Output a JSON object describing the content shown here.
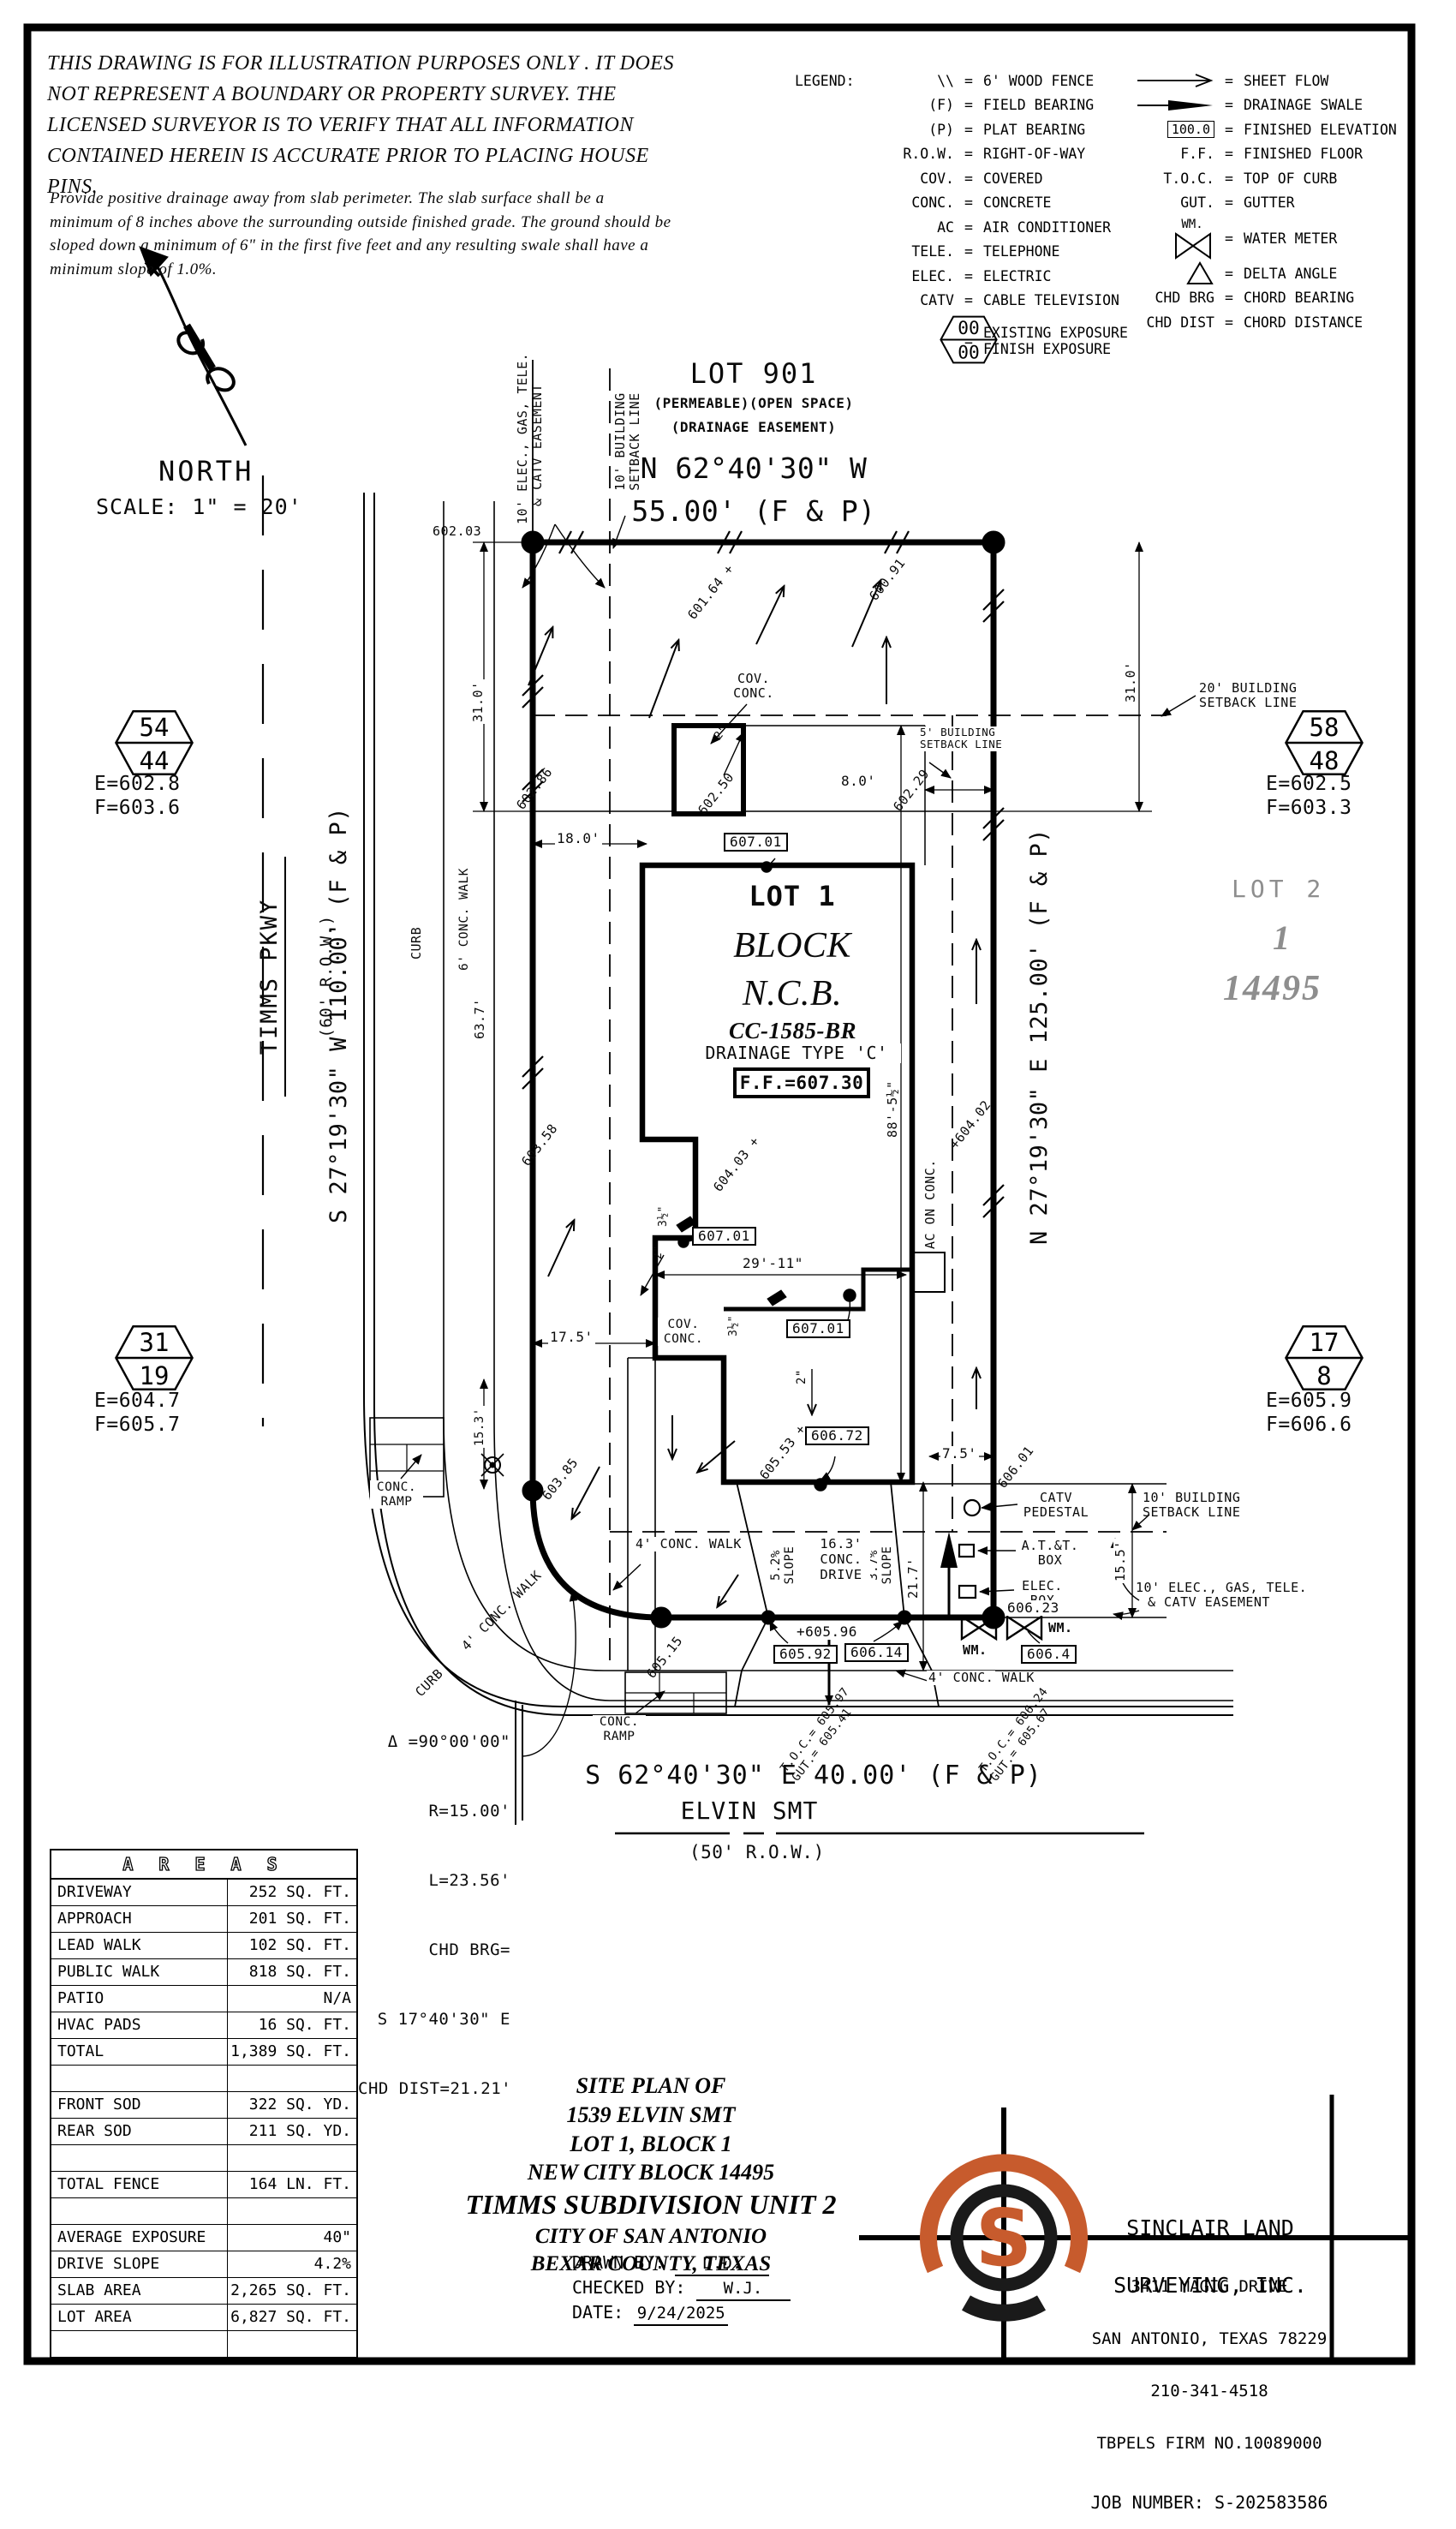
{
  "colors": {
    "accent": "#c75b2d",
    "screened": "#8e8e8e",
    "ink": "#000000"
  },
  "disclaimer": {
    "para1": "THIS DRAWING IS FOR ILLUSTRATION PURPOSES ONLY . IT DOES\nNOT REPRESENT A BOUNDARY OR PROPERTY SURVEY. THE\nLICENSED SURVEYOR IS TO VERIFY THAT ALL INFORMATION\nCONTAINED HEREIN IS ACCURATE PRIOR TO PLACING HOUSE PINS.",
    "para2": "Provide positive drainage away from slab perimeter. The slab surface shall be a\nminimum of 8 inches above the surrounding outside finished grade. The ground should be\nsloped down a minimum of 6\" in the first five feet and any resulting swale shall have a\nminimum slope of 1.0%."
  },
  "north": {
    "label": "NORTH",
    "scale": "SCALE: 1\" = 20'"
  },
  "legend": {
    "title": "LEGEND:",
    "eq": "=",
    "hex_top": "00",
    "hex_bottom": "00",
    "hex_label1": "EXISTING EXPOSURE",
    "hex_label2": "FINISH EXPOSURE",
    "wm": "WM.",
    "fe_box": "100.0",
    "left": [
      {
        "sym": "\\\\",
        "label": "6' WOOD FENCE"
      },
      {
        "sym": "(F)",
        "label": "FIELD BEARING"
      },
      {
        "sym": "(P)",
        "label": "PLAT BEARING"
      },
      {
        "sym": "R.O.W.",
        "label": "RIGHT-OF-WAY"
      },
      {
        "sym": "COV.",
        "label": "COVERED"
      },
      {
        "sym": "CONC.",
        "label": "CONCRETE"
      },
      {
        "sym": "AC",
        "label": "AIR CONDITIONER"
      },
      {
        "sym": "TELE.",
        "label": "TELEPHONE"
      },
      {
        "sym": "ELEC.",
        "label": "ELECTRIC"
      },
      {
        "sym": "CATV",
        "label": "CABLE TELEVISION"
      }
    ],
    "right": [
      {
        "sym": "",
        "label": "SHEET FLOW"
      },
      {
        "sym": "",
        "label": "DRAINAGE SWALE"
      },
      {
        "sym": "",
        "label": "FINISHED ELEVATION"
      },
      {
        "sym": "F.F.",
        "label": "FINISHED FLOOR"
      },
      {
        "sym": "T.O.C.",
        "label": "TOP OF CURB"
      },
      {
        "sym": "GUT.",
        "label": "GUTTER"
      },
      {
        "sym": "",
        "label": "WATER METER"
      },
      {
        "sym": "",
        "label": "DELTA ANGLE"
      },
      {
        "sym": "CHD BRG",
        "label": "CHORD BEARING"
      },
      {
        "sym": "CHD DIST",
        "label": "CHORD DISTANCE"
      }
    ]
  },
  "plan": {
    "lot901_name": "LOT 901",
    "lot901_a": "(PERMEABLE)(OPEN SPACE)",
    "lot901_b": "(DRAINAGE EASEMENT)",
    "brg_n1": "N 62°40'30\" W",
    "brg_n2": "55.00' (F & P)",
    "brg_w": "S 27°19'30\" W 110.00' (F & P)",
    "brg_e": "N 27°19'30\" E 125.00' (F & P)",
    "brg_s": "S 62°40'30\" E 40.00' (F & P)",
    "street_w1": "TIMMS PKWY",
    "street_w2": "(60' R.O.W.)",
    "street_s": "ELVIN SMT",
    "street_s_row": "(50' R.O.W.)",
    "ease_l1": "10' ELEC., GAS, TELE.",
    "ease_l2": "& CATV EASEMENT",
    "bsl10_1": "10' BUILDING",
    "bsl10_2": "SETBACK LINE",
    "bsl20_1": "20' BUILDING",
    "bsl20_2": "SETBACK LINE",
    "bsl5_1": "5' BUILDING",
    "bsl5_2": "SETBACK LINE",
    "lot1": "LOT 1",
    "block": "BLOCK",
    "ncb": "N.C.B.",
    "cc": "CC-1585-BR",
    "drain": "DRAINAGE TYPE 'C'",
    "ff": "F.F.=607.30",
    "lot2": "LOT 2",
    "lot2_blk": "1",
    "lot2_ncb": "14495",
    "cov1a": "COV.",
    "cov1b": "CONC.",
    "cov2a": "COV.",
    "cov2b": "CONC.",
    "ramp_a": "CONC.",
    "ramp_b": "RAMP",
    "walk6": "6' CONC. WALK",
    "walk4": "4' CONC. WALK",
    "curb": "CURB",
    "drive1": "16.3'",
    "drive2": "CONC.",
    "drive3": "DRIVE",
    "slope_a": "5.2%",
    "slope_b": "3.7%",
    "slope_w": "SLOPE",
    "ac": "AC ON CONC.",
    "catv1": "CATV",
    "catv2": "PEDESTAL",
    "att1": "A.T.&T.",
    "att2": "BOX",
    "elec1": "ELEC.",
    "elec2": "BOX",
    "wm": "WM.",
    "d31": "31.0'",
    "d18": "18.0'",
    "d63": "63.7'",
    "d17": "17.5'",
    "d29": "29'-11\"",
    "d88": "88'-5½\"",
    "d8": "8.0'",
    "d75": "7.5'",
    "d153": "15.3'",
    "d155": "15.5'",
    "d217": "21.7'",
    "in35": "3½\"",
    "in2": "2\"",
    "toc1a": "T.O.C.= 605.97",
    "toc1b": "GUT.= 605.41",
    "toc2a": "T.O.C.= 606.24",
    "toc2b": "GUT.= 605.67",
    "delta1": "Δ =90°00'00\"",
    "delta2": "R=15.00'",
    "delta3": "L=23.56'",
    "delta4": "CHD BRG=",
    "delta5": "S 17°40'30\" E",
    "delta6": "CHD DIST=21.21'",
    "e602_03": "602.03",
    "e601_64": "601.64 +",
    "e600_91": "600.91",
    "e602_86": "602.86",
    "e602_50": "602.50",
    "e602_29": "602.29",
    "e603_58": "603.58",
    "e604_03": "604.03 +",
    "e604_02": "+604.02",
    "e605_53": "605.53 +",
    "e603_85": "603.85",
    "e605_15": "605.15",
    "e606_01": "606.01",
    "e605_96": "+605.96",
    "e606_23": "606.23",
    "b607": "607.01",
    "b606_72": "606.72",
    "b605_92": "605.92",
    "b606_14": "606.14",
    "b606_4": "606.4"
  },
  "hexes": [
    {
      "top": "54",
      "bottom": "44",
      "e": "E=602.8",
      "f": "F=603.6"
    },
    {
      "top": "58",
      "bottom": "48",
      "e": "E=602.5",
      "f": "F=603.3"
    },
    {
      "top": "31",
      "bottom": "19",
      "e": "E=604.7",
      "f": "F=605.7"
    },
    {
      "top": "17",
      "bottom": "8",
      "e": "E=605.9",
      "f": "F=606.6"
    }
  ],
  "areas": {
    "title": "A R E A S",
    "rows": [
      {
        "label": "DRIVEWAY",
        "value": "252 SQ. FT."
      },
      {
        "label": "APPROACH",
        "value": "201 SQ. FT."
      },
      {
        "label": "LEAD WALK",
        "value": "102 SQ. FT."
      },
      {
        "label": "PUBLIC WALK",
        "value": "818 SQ. FT."
      },
      {
        "label": "PATIO",
        "value": "N/A"
      },
      {
        "label": "HVAC PADS",
        "value": "16 SQ. FT."
      },
      {
        "label": "TOTAL",
        "value": "1,389 SQ. FT."
      },
      {
        "label": "",
        "value": ""
      },
      {
        "label": "FRONT SOD",
        "value": "322 SQ. YD."
      },
      {
        "label": "REAR SOD",
        "value": "211 SQ. YD."
      },
      {
        "label": "",
        "value": ""
      },
      {
        "label": "TOTAL FENCE",
        "value": "164 LN. FT."
      },
      {
        "label": "",
        "value": ""
      },
      {
        "label": "AVERAGE EXPOSURE",
        "value": "40\""
      },
      {
        "label": "DRIVE SLOPE",
        "value": "4.2%"
      },
      {
        "label": "SLAB AREA",
        "value": "2,265 SQ. FT."
      },
      {
        "label": "LOT AREA",
        "value": "6,827 SQ. FT."
      },
      {
        "label": "",
        "value": ""
      }
    ]
  },
  "title_block": {
    "l1": "SITE PLAN OF",
    "l2": "1539 ELVIN SMT",
    "l3": "LOT 1, BLOCK 1",
    "l4": "NEW CITY BLOCK 14495",
    "l5": "TIMMS SUBDIVISION UNIT 2",
    "l6": "CITY OF SAN ANTONIO",
    "l7": "BEXAR COUNTY, TEXAS",
    "drawn_label": "DRAWN BY:",
    "drawn": "D.D.",
    "checked_label": "CHECKED BY:",
    "checked": "W.J.",
    "date_label": "DATE:",
    "date": "9/24/2025"
  },
  "firm": {
    "logo_letter": "S",
    "name1": "SINCLAIR LAND",
    "name2": "SURVEYING, INC.",
    "addr1": "3411 MAGIC DRIVE",
    "addr2": "SAN ANTONIO, TEXAS 78229",
    "phone": "210-341-4518",
    "tbpels": "TBPELS FIRM NO.10089000",
    "job": "JOB NUMBER: S-202583586"
  }
}
